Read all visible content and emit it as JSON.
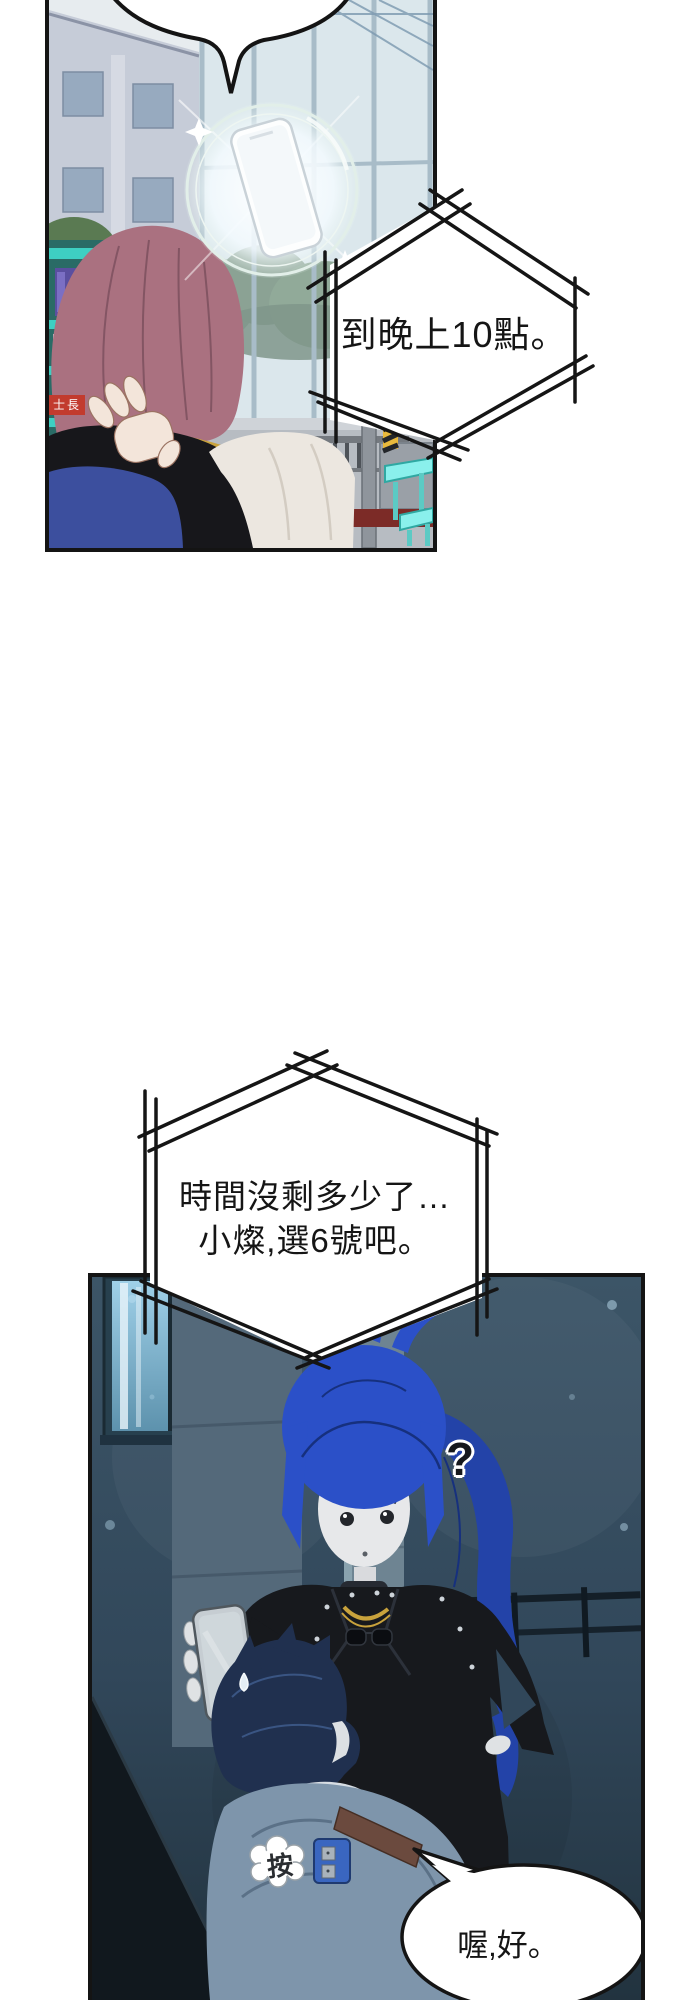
{
  "comic": {
    "bubble1": {
      "text": "到晚上10點。"
    },
    "bubble2": {
      "line1": "時間沒剩多少了…",
      "line2": "小燦,選6號吧。"
    },
    "bubble3": {
      "text": "喔,好。"
    },
    "sfx": {
      "text": "按"
    },
    "question": {
      "text": "?"
    },
    "store_sign": {
      "text": "士長"
    }
  },
  "colors": {
    "page_bg": "#ffffff",
    "panel_border": "#141414",
    "hair_top_figure": "#aa7180",
    "vest_black": "#17171b",
    "sleeve_white": "#ece7e0",
    "garment_blue": "#3c4f9e",
    "shelf_teal": "#3ecfc2",
    "sign_red": "#c23b2e",
    "lantern_red": "#c8281e",
    "table_cyan": "#8af0ec",
    "night_wall": "#31475a",
    "girl_hair": "#2b50c8",
    "girl_hair_dark": "#2343a8",
    "boy_hair": "#20304f",
    "boy_jacket": "#7e95ab",
    "jacket_black": "#17191d",
    "phone_grey": "#c6cdd2",
    "gadget_blue": "#3a66c0",
    "gold": "#c8a23c",
    "glow": "#f4fbff"
  }
}
